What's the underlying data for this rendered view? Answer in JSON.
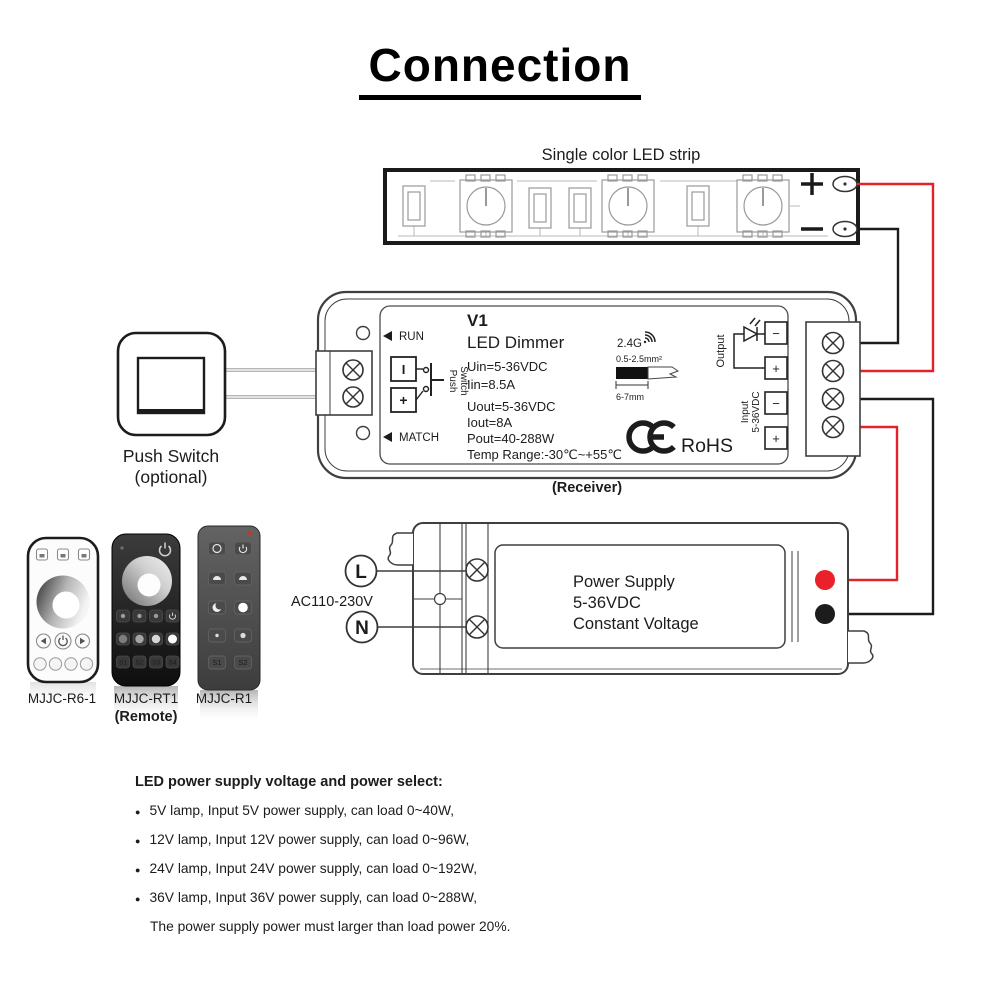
{
  "title": "Connection",
  "colors": {
    "wire_red": "#e1232a",
    "wire_black": "#1c1c1c",
    "terminal_red_dot": "#e8212b",
    "terminal_black_dot": "#1c1c1c",
    "live_letter_red": "#e03131"
  },
  "strip": {
    "label": "Single color LED strip",
    "plus": "+",
    "minus": "−"
  },
  "push_switch": {
    "label": "Push Switch",
    "sub": "(optional)"
  },
  "receiver": {
    "caption": "(Receiver)",
    "run": "RUN",
    "match": "MATCH",
    "model": "V1",
    "product": "LED Dimmer",
    "uin": "Uin=5-36VDC",
    "iin": "Iin=8.5A",
    "uout": "Uout=5-36VDC",
    "iout": "Iout=8A",
    "pout": "Pout=40-288W",
    "temp": "Temp Range:-30℃~+55℃",
    "sw_i": "I",
    "sw_plus": "+",
    "sw_push": "Push",
    "sw_switch": "Switch",
    "rf": "2.4G",
    "gauge": "0.5-2.5mm²",
    "strip_len": "6-7mm",
    "ce": "CE",
    "rohs": "RoHS",
    "output": "Output",
    "input": "Input",
    "input_v": "5-36VDC",
    "o_minus": "−",
    "o_plus": "+",
    "i_minus": "−",
    "i_plus": "+"
  },
  "power_supply": {
    "l": "L",
    "n": "N",
    "ac": "AC110-230V",
    "line1": "Power Supply",
    "line2": "5-36VDC",
    "line3": "Constant Voltage"
  },
  "remotes": {
    "r6": {
      "model": "MJJC-R6-1"
    },
    "rt1": {
      "model": "MJJC-RT1",
      "caption": "(Remote)",
      "keys": [
        "S1",
        "S2",
        "S3",
        "S4"
      ]
    },
    "r1": {
      "model": "MJJC-R1",
      "keys": [
        "S1",
        "S2"
      ]
    }
  },
  "notes": {
    "bullet": "●",
    "heading": "LED power supply voltage and power select:",
    "items": [
      "5V lamp, Input 5V power supply, can load 0~40W,",
      "12V lamp, Input 12V power supply, can load 0~96W,",
      "24V lamp, Input 24V power supply, can load 0~192W,",
      "36V lamp, Input 36V power supply, can load 0~288W,"
    ],
    "footer": "The power supply power must larger than load power 20%."
  }
}
